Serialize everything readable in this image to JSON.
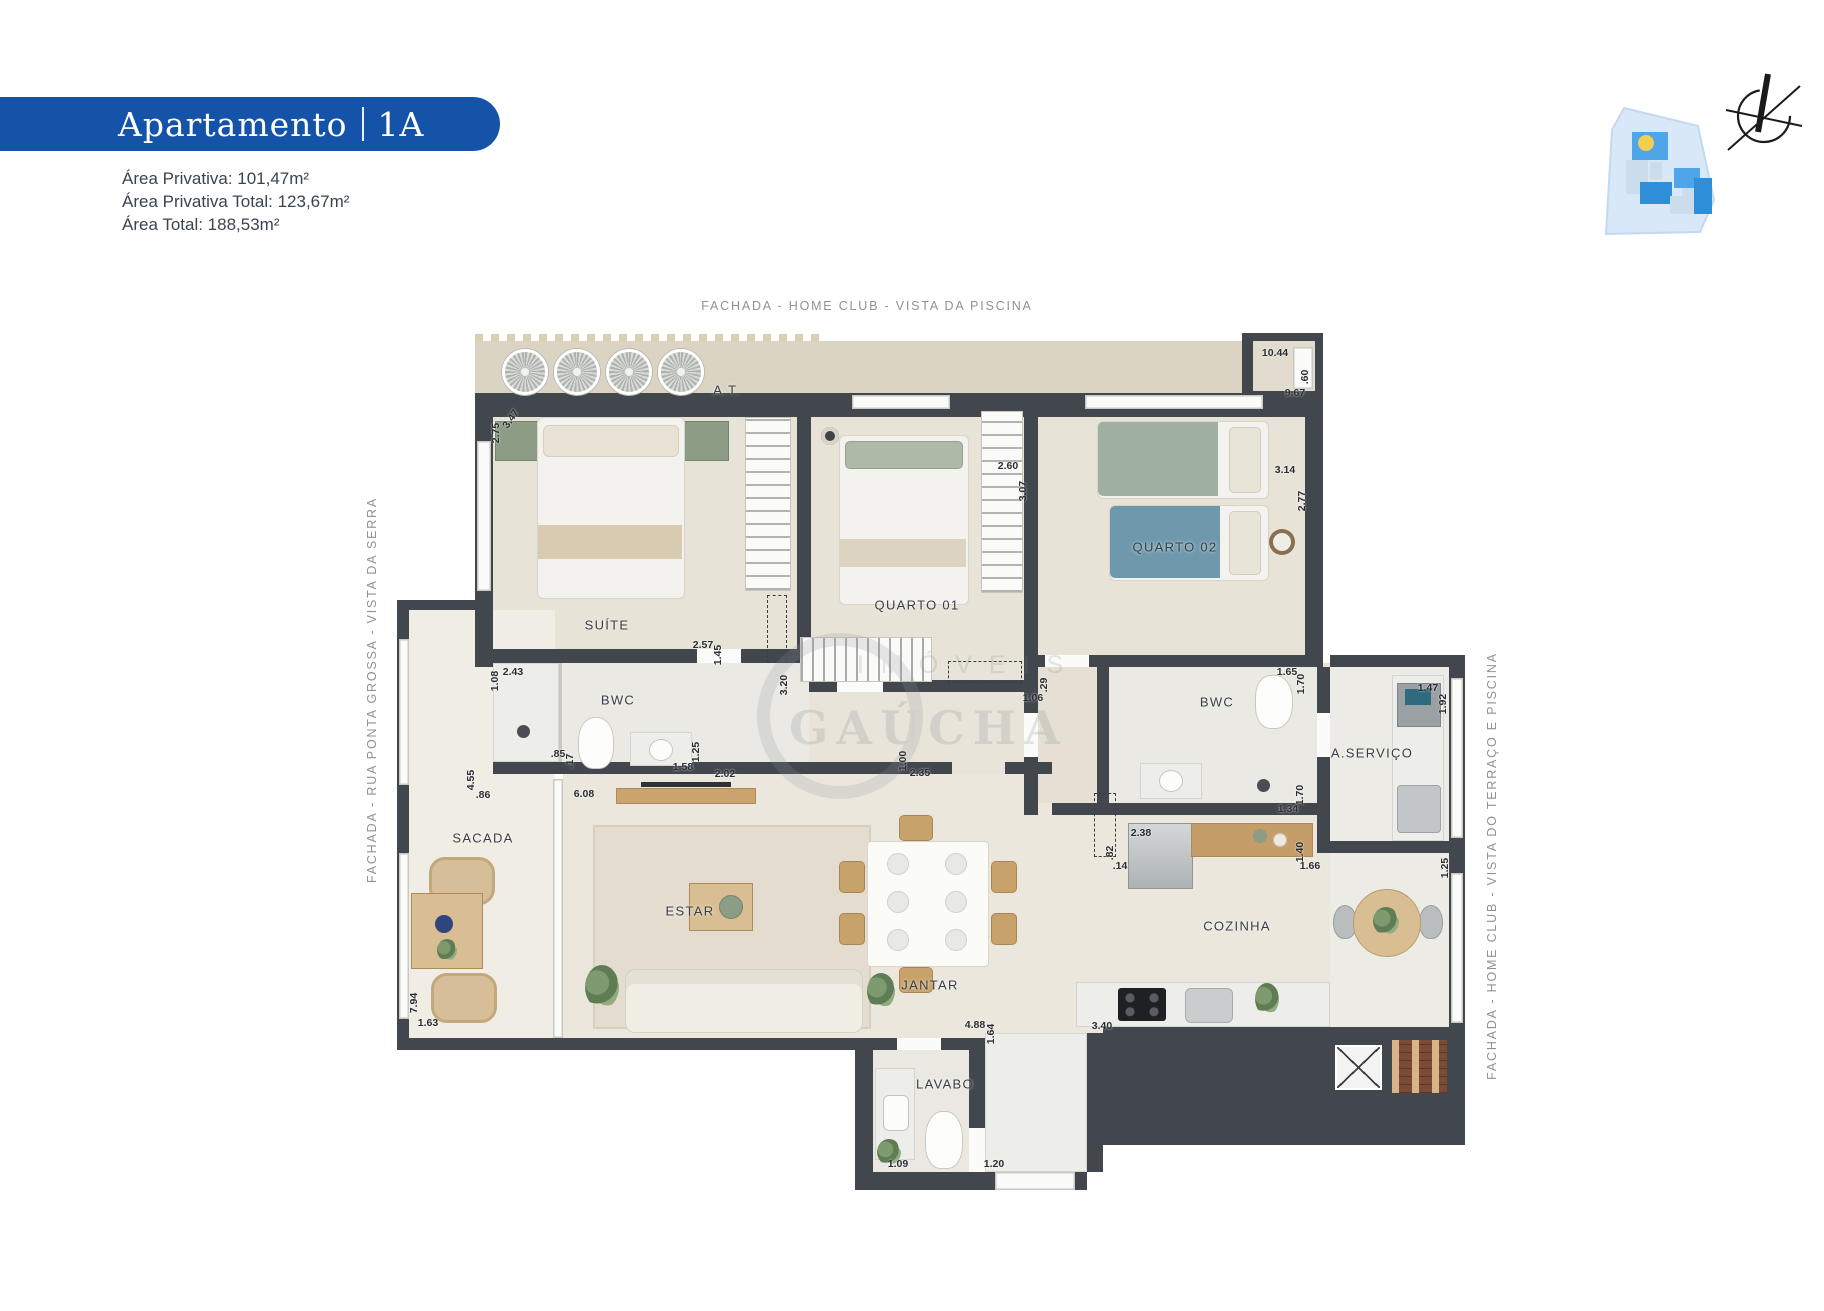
{
  "header": {
    "badge": {
      "title": "Apartamento",
      "unit": "1A",
      "bg": "#1553A8",
      "text_color": "#FFFFFF"
    },
    "areas": [
      {
        "text": "Área Privativa:  101,47m²"
      },
      {
        "text": "Área Privativa Total: 123,67m²"
      },
      {
        "text": "Área Total: 188,53m²"
      }
    ]
  },
  "facades": {
    "top": "FACHADA - HOME CLUB - VISTA DA PISCINA",
    "left": "FACHADA - RUA PONTA GROSSA - VISTA DA SERRA",
    "right": "FACHADA - HOME CLUB - VISTA DO TERRAÇO E PISCINA"
  },
  "watermark": {
    "word1": "IMÓVEIS",
    "word2": "GAÚCHA"
  },
  "icons": {
    "keyplan": "site-keyplan",
    "compass": "north-compass",
    "unit_highlight_color": "#F2CF4E"
  },
  "colors": {
    "badge_blue": "#1553A8",
    "wall": "#42464D",
    "floor": "#EAE6DB",
    "marble": "#EDEEEA",
    "wood": "#CBA36F",
    "facade_gray": "#8E9397",
    "text_dark": "#3A3F45"
  },
  "rooms": [
    {
      "id": "at",
      "label": "A.T.",
      "x": 330,
      "y": 57
    },
    {
      "id": "suite",
      "label": "SUÍTE",
      "x": 210,
      "y": 292
    },
    {
      "id": "quarto01",
      "label": "QUARTO 01",
      "x": 520,
      "y": 272
    },
    {
      "id": "quarto02",
      "label": "QUARTO 02",
      "x": 778,
      "y": 214
    },
    {
      "id": "bwc1",
      "label": "BWC",
      "x": 221,
      "y": 367
    },
    {
      "id": "bwc2",
      "label": "BWC",
      "x": 820,
      "y": 369
    },
    {
      "id": "aservico",
      "label": "A.SERVIÇO",
      "x": 975,
      "y": 420
    },
    {
      "id": "sacada",
      "label": "SACADA",
      "x": 86,
      "y": 505
    },
    {
      "id": "estar",
      "label": "ESTAR",
      "x": 293,
      "y": 578
    },
    {
      "id": "jantar",
      "label": "JANTAR",
      "x": 533,
      "y": 652
    },
    {
      "id": "cozinha",
      "label": "COZINHA",
      "x": 840,
      "y": 593
    },
    {
      "id": "lavabo",
      "label": "LAVABO",
      "x": 548,
      "y": 751
    }
  ],
  "dims": [
    {
      "v": "10.44",
      "x": 878,
      "y": 20,
      "r": 0
    },
    {
      "v": ".60",
      "x": 908,
      "y": 44,
      "r": -90
    },
    {
      "v": "9.67",
      "x": 898,
      "y": 60,
      "r": 0
    },
    {
      "v": "2.75",
      "x": 99,
      "y": 100,
      "r": -90
    },
    {
      "v": "3.47",
      "x": 114,
      "y": 86,
      "r": -55
    },
    {
      "v": "2.60",
      "x": 611,
      "y": 133,
      "r": 0
    },
    {
      "v": "3.07",
      "x": 626,
      "y": 158,
      "r": -90
    },
    {
      "v": "3.14",
      "x": 888,
      "y": 137,
      "r": 0
    },
    {
      "v": "2.77",
      "x": 905,
      "y": 168,
      "r": -90
    },
    {
      "v": "2.57",
      "x": 306,
      "y": 312,
      "r": 0
    },
    {
      "v": "1.45",
      "x": 321,
      "y": 322,
      "r": -90
    },
    {
      "v": "2.43",
      "x": 116,
      "y": 339,
      "r": 0
    },
    {
      "v": "1.08",
      "x": 98,
      "y": 348,
      "r": -90
    },
    {
      "v": ".85",
      "x": 161,
      "y": 421,
      "r": 0
    },
    {
      "v": ".17",
      "x": 173,
      "y": 428,
      "r": -90
    },
    {
      "v": "1.58",
      "x": 286,
      "y": 434,
      "r": 0
    },
    {
      "v": "1.25",
      "x": 299,
      "y": 419,
      "r": -90
    },
    {
      "v": "2.02",
      "x": 328,
      "y": 441,
      "r": 0
    },
    {
      "v": "3.20",
      "x": 387,
      "y": 352,
      "r": -90
    },
    {
      "v": "1.06",
      "x": 636,
      "y": 365,
      "r": 0
    },
    {
      "v": ".29",
      "x": 647,
      "y": 352,
      "r": -90
    },
    {
      "v": "1.00",
      "x": 506,
      "y": 428,
      "r": -90
    },
    {
      "v": "2.35",
      "x": 523,
      "y": 440,
      "r": 0
    },
    {
      "v": "1.65",
      "x": 890,
      "y": 339,
      "r": 0
    },
    {
      "v": "1.70",
      "x": 904,
      "y": 351,
      "r": -90
    },
    {
      "v": "1.70",
      "x": 903,
      "y": 462,
      "r": -90
    },
    {
      "v": "1.34",
      "x": 891,
      "y": 476,
      "r": 0
    },
    {
      "v": "1.47",
      "x": 1031,
      "y": 355,
      "r": 0
    },
    {
      "v": "1.92",
      "x": 1046,
      "y": 371,
      "r": -90
    },
    {
      "v": "1.25",
      "x": 1048,
      "y": 535,
      "r": -90
    },
    {
      "v": "2.38",
      "x": 744,
      "y": 500,
      "r": 0
    },
    {
      "v": ".82",
      "x": 713,
      "y": 520,
      "r": -90
    },
    {
      "v": ".14",
      "x": 723,
      "y": 533,
      "r": 0
    },
    {
      "v": "1.40",
      "x": 903,
      "y": 519,
      "r": -90
    },
    {
      "v": "1.66",
      "x": 913,
      "y": 533,
      "r": 0
    },
    {
      "v": "4.55",
      "x": 74,
      "y": 447,
      "r": -90
    },
    {
      "v": ".86",
      "x": 86,
      "y": 462,
      "r": 0
    },
    {
      "v": "6.08",
      "x": 187,
      "y": 461,
      "r": 0
    },
    {
      "v": "7.94",
      "x": 17,
      "y": 670,
      "r": -90
    },
    {
      "v": "1.63",
      "x": 31,
      "y": 690,
      "r": 0
    },
    {
      "v": "4.88",
      "x": 578,
      "y": 692,
      "r": 0
    },
    {
      "v": "1.64",
      "x": 594,
      "y": 701,
      "r": -90
    },
    {
      "v": "1.09",
      "x": 501,
      "y": 831,
      "r": 0
    },
    {
      "v": "1.20",
      "x": 597,
      "y": 831,
      "r": 0
    },
    {
      "v": "3.40",
      "x": 705,
      "y": 693,
      "r": 0
    }
  ]
}
